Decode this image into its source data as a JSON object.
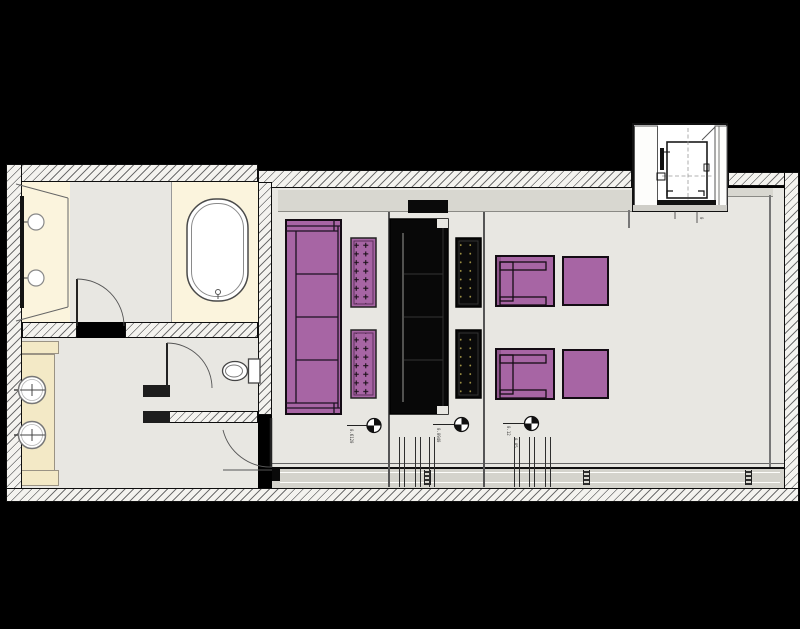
{
  "drawing": {
    "kind": "floor-plan"
  },
  "palette": {
    "background": "#000000",
    "wall_fill": "#f4f3ef",
    "hatch_line": "#6f6f6f",
    "floor_gray": "#e8e7e2",
    "floor_cream": "#fbf4dd",
    "counter_cream": "#f3e9c6",
    "soffit_gray": "#d8d7d0",
    "window_band": "#d4d3cc",
    "furniture_purple": "#a765a4",
    "furniture_black": "#0a0a0a",
    "tuft_dot": "#a39546",
    "line_dark": "#111111"
  },
  "icons": {
    "level_marker": "quadrant-circle",
    "door": "quarter-arc-swing"
  },
  "annotations": {
    "marker_1_level": "0.6120",
    "marker_2_level": "0.0940",
    "marker_3_level_a": "0.12",
    "marker_3_level_b": "0.85",
    "elevator_mark": "0"
  }
}
